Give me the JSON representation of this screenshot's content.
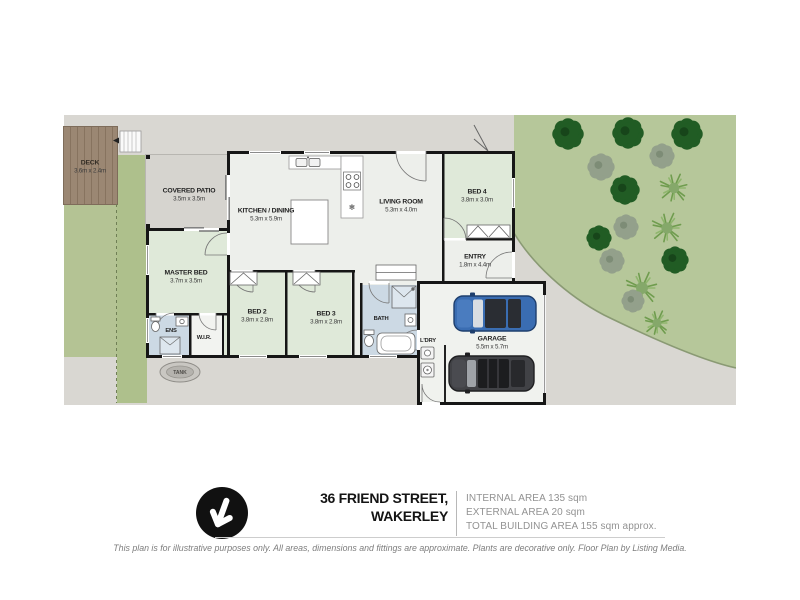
{
  "rooms": {
    "deck": {
      "name": "DECK",
      "dims": "3.6m x 2.4m"
    },
    "covered_patio": {
      "name": "COVERED PATIO",
      "dims": "3.5m x 3.5m"
    },
    "kitchen_dining": {
      "name": "KITCHEN / DINING",
      "dims": "5.3m x 5.9m"
    },
    "living_room": {
      "name": "LIVING ROOM",
      "dims": "5.3m x 4.0m"
    },
    "bed4": {
      "name": "BED 4",
      "dims": "3.8m x 3.0m"
    },
    "entry": {
      "name": "ENTRY",
      "dims": "1.8m x 4.4m"
    },
    "master_bed": {
      "name": "MASTER BED",
      "dims": "3.7m x 3.5m"
    },
    "bed2": {
      "name": "BED 2",
      "dims": "3.8m x 2.8m"
    },
    "bed3": {
      "name": "BED 3",
      "dims": "3.8m x 2.8m"
    },
    "ens": {
      "name": "ENS"
    },
    "wir": {
      "name": "W.I.R."
    },
    "bath": {
      "name": "BATH"
    },
    "ldry": {
      "name": "L'DRY"
    },
    "garage": {
      "name": "GARAGE",
      "dims": "5.5m x 5.7m"
    },
    "tank": {
      "name": "TANK"
    }
  },
  "footer": {
    "address_line1": "36 FRIEND STREET,",
    "address_line2": "WAKERLEY",
    "areas": [
      "INTERNAL AREA 135 sqm",
      "EXTERNAL AREA 20 sqm",
      "TOTAL BUILDING AREA 155 sqm approx."
    ],
    "disclaimer": "This plan is for illustrative purposes only. All areas, dimensions and fittings are approximate. Plants are decorative only. Floor Plan by Listing Media."
  },
  "colors": {
    "wall": "#161616",
    "grass": "#b4c394",
    "garden": "#b6c79a",
    "concrete": "#d9d7d2",
    "deck_wood": "#9b8773",
    "bedroom_floor": "#dfe9d9",
    "wet_area_floor": "#ccd9e4",
    "car_blue": "#3a6db2",
    "car_dark": "#414246",
    "logo": "#111111"
  }
}
